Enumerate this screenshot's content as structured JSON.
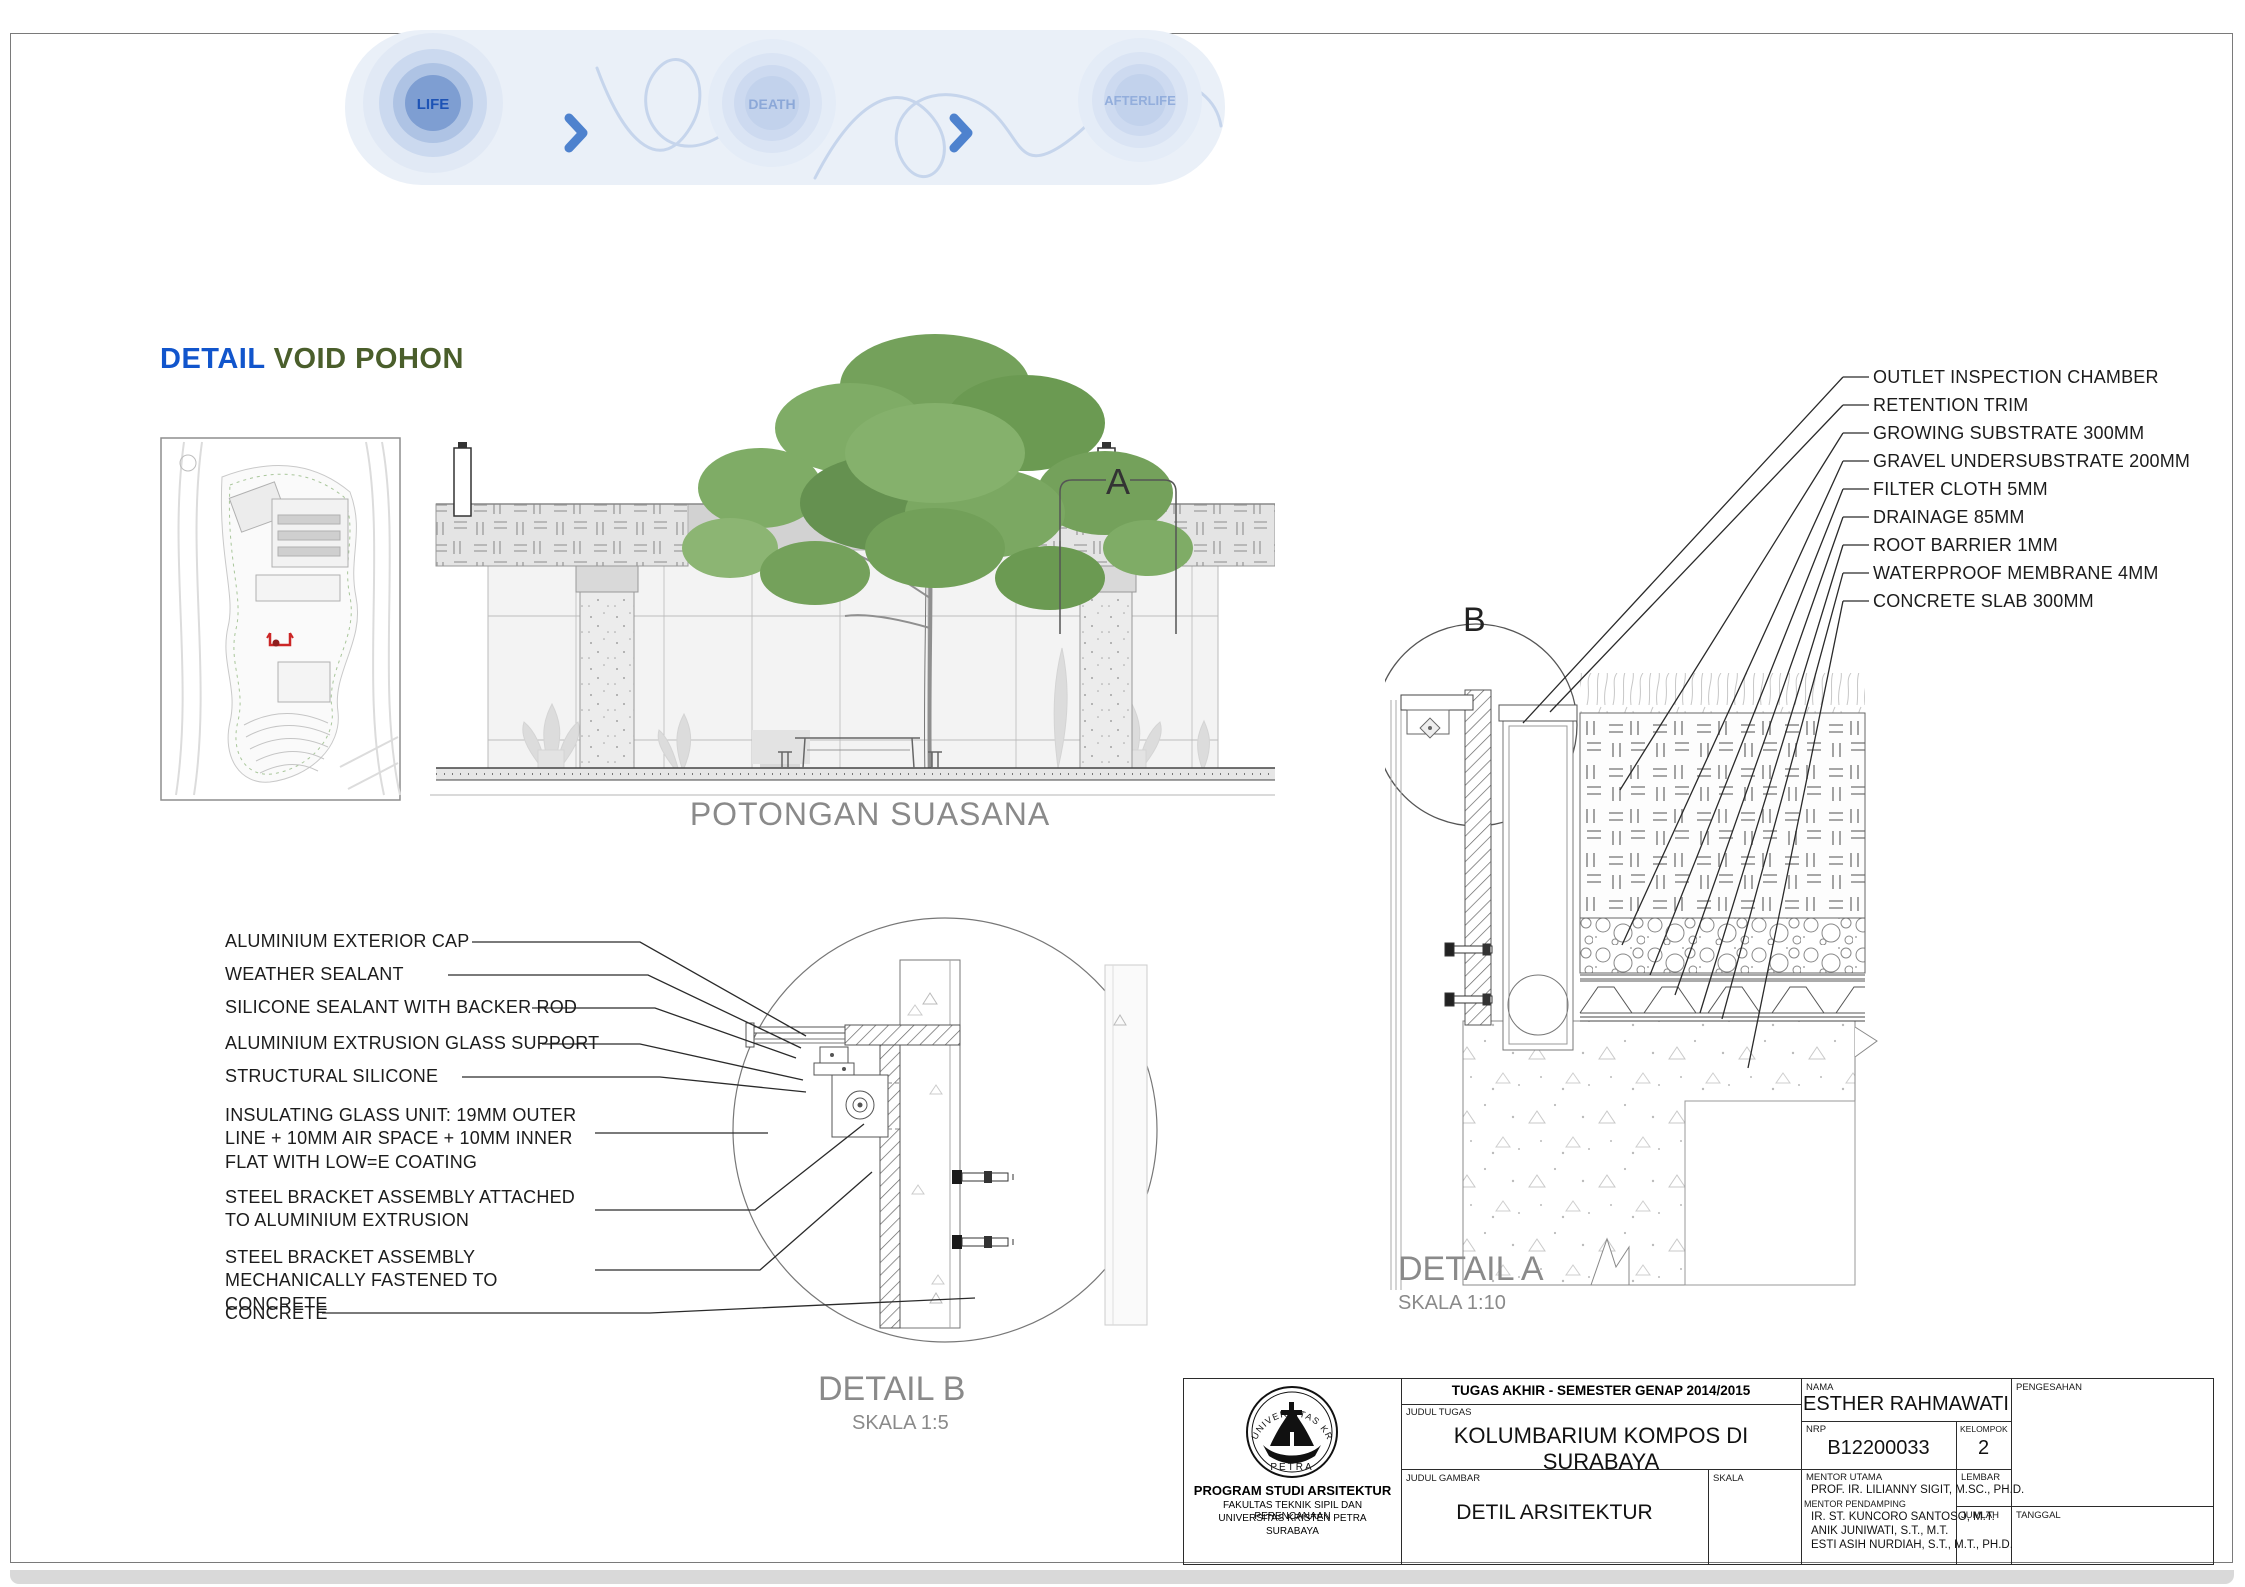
{
  "banner": {
    "stages": [
      {
        "label": "LIFE"
      },
      {
        "label": "DEATH"
      },
      {
        "label": "AFTERLIFE"
      }
    ]
  },
  "heading": {
    "word1": "DETAIL",
    "word2": "VOID POHON"
  },
  "section": {
    "caption": "POTONGAN SUASANA",
    "marker": "A"
  },
  "detail_a": {
    "title": "DETAIL A",
    "scale": "SKALA 1:10",
    "marker": "B",
    "callouts": [
      "OUTLET INSPECTION CHAMBER",
      "RETENTION TRIM",
      "GROWING SUBSTRATE 300MM",
      "GRAVEL UNDERSUBSTRATE 200MM",
      "FILTER CLOTH 5MM",
      "DRAINAGE 85MM",
      "ROOT BARRIER 1MM",
      "WATERPROOF MEMBRANE 4MM",
      "CONCRETE SLAB 300MM"
    ]
  },
  "detail_b": {
    "title": "DETAIL B",
    "scale": "SKALA 1:5",
    "callouts": [
      "ALUMINIUM EXTERIOR CAP",
      "WEATHER SEALANT",
      "SILICONE SEALANT WITH BACKER ROD",
      "ALUMINIUM EXTRUSION GLASS SUPPORT",
      "STRUCTURAL SILICONE",
      "INSULATING GLASS UNIT: 19MM OUTER LINE + 10MM AIR SPACE + 10MM INNER FLAT WITH LOW=E COATING",
      "STEEL BRACKET ASSEMBLY ATTACHED TO ALUMINIUM EXTRUSION",
      "STEEL BRACKET ASSEMBLY MECHANICALLY FASTENED TO CONCRETE",
      "CONCRETE"
    ]
  },
  "title_block": {
    "header": "TUGAS AKHIR - SEMESTER GENAP 2014/2015",
    "judul_tugas_label": "JUDUL TUGAS",
    "judul_tugas": "KOLUMBARIUM KOMPOS DI SURABAYA",
    "judul_gambar_label": "JUDUL GAMBAR",
    "judul_gambar": "DETIL ARSITEKTUR",
    "skala_label": "SKALA",
    "nama_label": "NAMA",
    "nama": "ESTHER RAHMAWATI",
    "nrp_label": "NRP",
    "nrp": "B12200033",
    "kelompok_label": "KELOMPOK",
    "kelompok": "2",
    "mentor_utama_label": "MENTOR UTAMA",
    "mentor_utama": "PROF. IR. LILIANNY SIGIT, M.SC., PH.D.",
    "mentor_pendamping_label": "MENTOR PENDAMPING",
    "mentor_pendamping": [
      "IR. ST. KUNCORO SANTOSO, M.T.",
      "ANIK JUNIWATI, S.T., M.T.",
      "ESTI ASIH NURDIAH, S.T., M.T., PH.D."
    ],
    "lembar_label": "LEMBAR",
    "jumlah_label": "JUMLAH",
    "tanggal_label": "TANGGAL",
    "pengesahan_label": "PENGESAHAN",
    "institution": {
      "program": "PROGRAM STUDI ARSITEKTUR",
      "fakultas": "FAKULTAS TEKNIK SIPIL DAN PERENCANAAN",
      "universitas": "UNIVERSITAS KRISTEN PETRA",
      "kota": "SURABAYA"
    },
    "logo": {
      "arc_text": "UNIVERSITAS KRISTEN",
      "bottom_text": "PETRA"
    }
  },
  "colors": {
    "accent_blue": "#1155CC",
    "accent_green": "#4A5E2B",
    "banner_core_blue": "#7E9ED2",
    "banner_text_dark": "#1D53B5",
    "banner_text_light": "#93AEDC",
    "drawing_gray": "#8A8A8A"
  }
}
